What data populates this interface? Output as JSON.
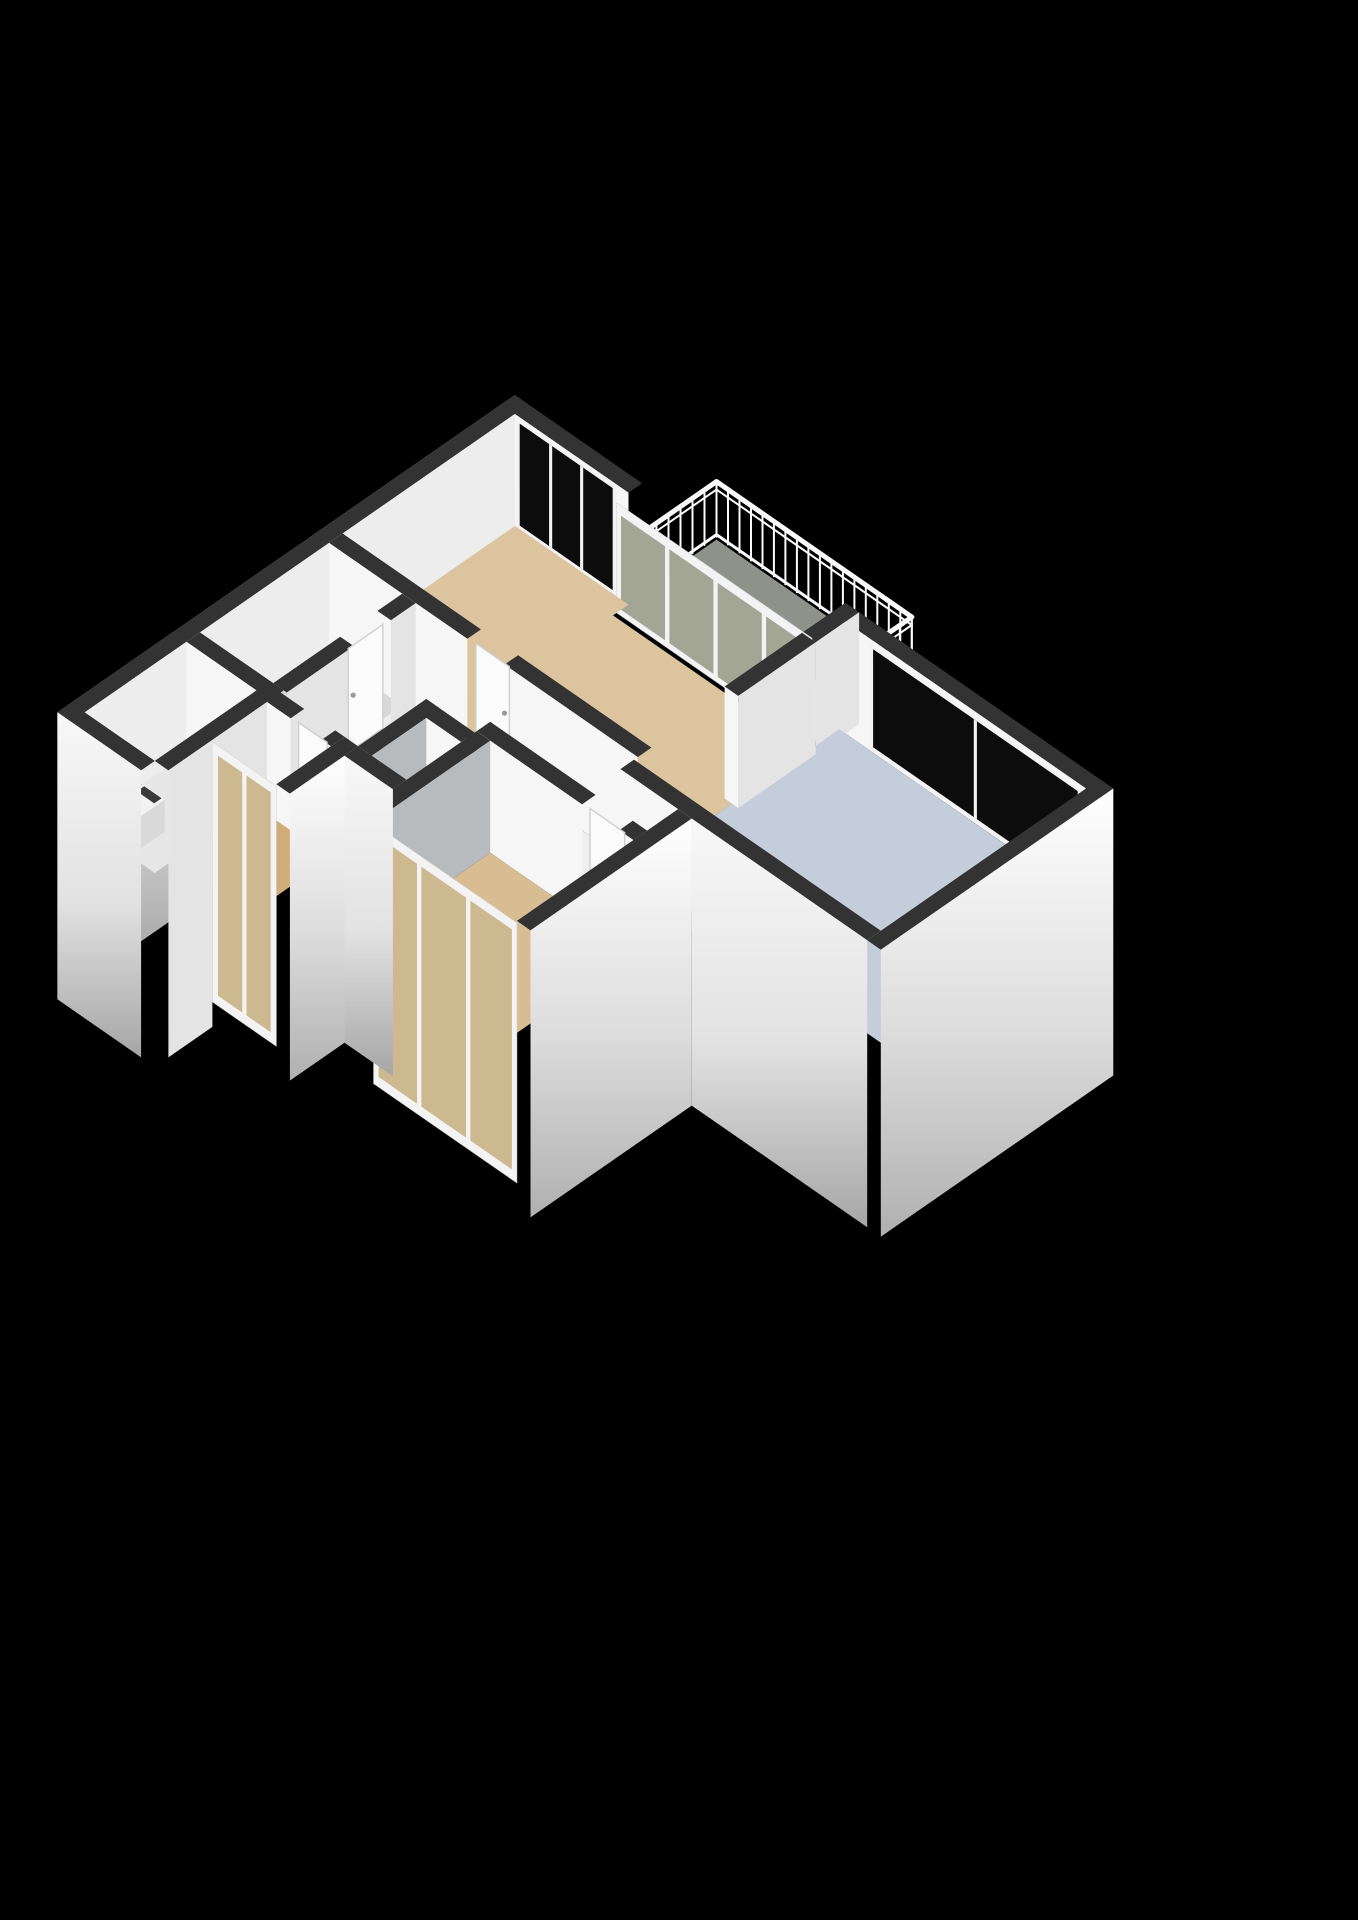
{
  "title": "3D isometric apartment floor plan render",
  "background": "#000000",
  "colors": {
    "wallTop": "#333333",
    "faceSW": "#f6f6f6",
    "faceSE": "#e4e4e4",
    "faceSE2": "#ededed",
    "faceSEdark": "#b7bbbe",
    "floorLiving": "#dbc49e",
    "floorKitchen": "#c4cdda",
    "floorWC": "#b7c3d7",
    "floorBedroom": "#d9bd92",
    "floorSmallRoom": "#d0ad79",
    "floorRoomL1": "#d8d8d8",
    "floorRoomL2": "#e7e7e7",
    "floorHall": "#efefef",
    "floorBalcony": "#8f928a",
    "glassOlive": "#a4a695",
    "glassBeige": "#cdb98f",
    "glassDark": "#0c0c0c",
    "frameWhite": "#f3f3f3",
    "railWhite": "#fbfbfb",
    "cooktopTop": "#161616",
    "cooktopFaceS": "#262626",
    "cooktopFaceE": "#1f1f1f",
    "burner": "#c0392b",
    "burnerRing": "#82251c",
    "doorWhite": "#fbfbfb",
    "doorEdge": "#cfcfcf",
    "doorHandle": "#9a9a9a",
    "toiletWhite": "#f8f8f8",
    "toiletShade": "#e6e6e6",
    "cisternTop": "#f6f6f6",
    "cisternS": "#e9e9e9",
    "cisternE": "#dedede",
    "washerTop": "#f3f3f3",
    "washerS": "#e6e6e6",
    "washerE": "#d9d9d9",
    "washerAccent": "#b03a30",
    "washerDark": "#3a3a3a",
    "gradW": [
      "#fdfdfd",
      "#ececec",
      "#9b9b9b"
    ],
    "gradE": [
      "#ffffff",
      "#dcdcdc",
      "#b0b0b0"
    ],
    "gradS": [
      "#f8f8f8",
      "#e2e2e2",
      "#a6a6a6"
    ]
  },
  "scene": {
    "type": "isometric-3d-floorplan",
    "rooms": [
      {
        "id": "living-room",
        "floor_color": "floorLiving"
      },
      {
        "id": "kitchen",
        "floor_color": "floorKitchen"
      },
      {
        "id": "balcony",
        "floor_color": "floorBalcony"
      },
      {
        "id": "wc",
        "floor_color": "floorWC"
      },
      {
        "id": "bedroom",
        "floor_color": "floorBedroom"
      },
      {
        "id": "small-room-bottom-left",
        "floor_color": "floorSmallRoom"
      },
      {
        "id": "storage-room-left",
        "floor_color": "floorRoomL1"
      },
      {
        "id": "laundry-room-left",
        "floor_color": "floorRoomL2"
      },
      {
        "id": "hall",
        "floor_color": "floorHall"
      }
    ],
    "fixtures": [
      {
        "id": "cooktop",
        "burners": 4,
        "burner_color": "#c0392b"
      },
      {
        "id": "toilet-with-cistern"
      },
      {
        "id": "washing-machine",
        "accent_color": "#b03a30"
      },
      {
        "id": "balcony-railing"
      }
    ],
    "glazing": [
      {
        "id": "living-room-tall-window",
        "glass": "glassDark"
      },
      {
        "id": "kitchen-window",
        "glass": "glassDark"
      },
      {
        "id": "living-balcony-glazed-wall",
        "glass": "glassOlive"
      },
      {
        "id": "bedroom-glazed-wall",
        "glass": "glassBeige"
      },
      {
        "id": "small-room-glazed-wall",
        "glass": "glassBeige"
      }
    ]
  }
}
